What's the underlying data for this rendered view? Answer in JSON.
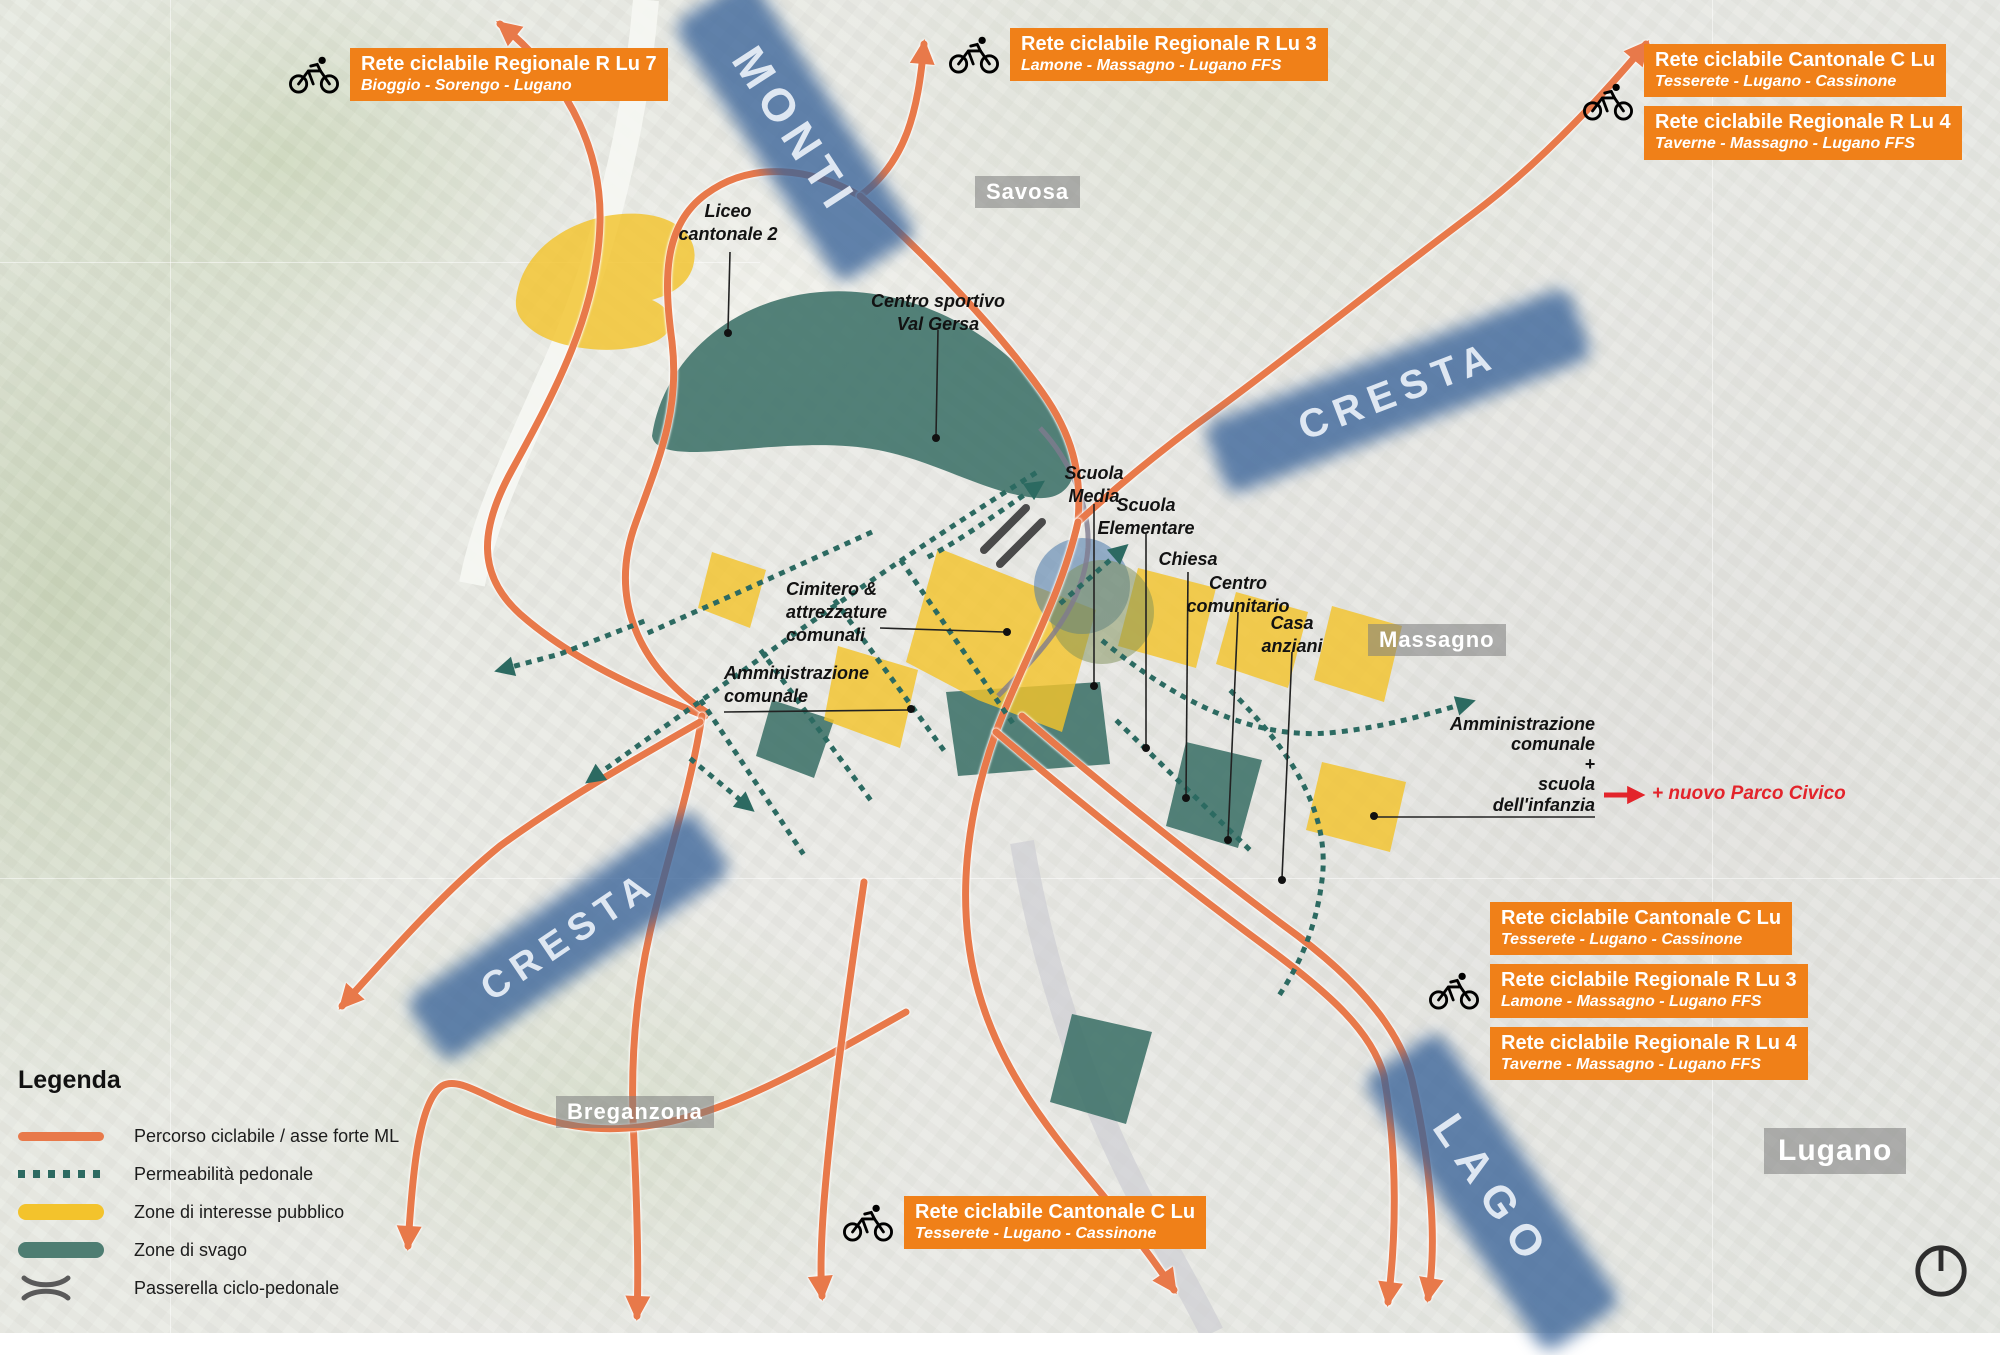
{
  "colors": {
    "route_orange": "#e8794a",
    "label_orange": "#f08018",
    "corridor_blue": "#3a669c",
    "zone_yellow": "#f3c32c",
    "zone_green": "#3c7168",
    "path_teal": "#2c6a61",
    "accent_red": "#e3242b",
    "passerella_gray": "#4a4a4a"
  },
  "corridors": [
    {
      "name": "MONTI"
    },
    {
      "name": "CRESTA"
    },
    {
      "name": "CRESTA"
    },
    {
      "name": "LAGO"
    }
  ],
  "places": [
    {
      "name": "Savosa"
    },
    {
      "name": "Massagno"
    },
    {
      "name": "Breganzona"
    },
    {
      "name": "Lugano"
    }
  ],
  "annotations": {
    "liceo": "Liceo\ncantonale 2",
    "centro_sportivo": "Centro sportivo\nVal Gersa",
    "scuola_media": "Scuola\nMedia",
    "scuola_elementare": "Scuola\nElementare",
    "chiesa": "Chiesa",
    "centro_comunitario": "Centro\ncomunitario",
    "casa_anziani": "Casa\nanziani",
    "cimitero": "Cimitero &\nattrezzature\ncomunali",
    "amministrazione_comunale": "Amministrazione\ncomunale",
    "amministrazione_scuola_infanzia": "Amministrazione\ncomunale\n+\nscuola\ndell'infanzia",
    "nuovo_parco_civico": "+ nuovo Parco Civico"
  },
  "route_labels": {
    "top_left": [
      {
        "title": "Rete ciclabile Regionale R Lu 7",
        "subtitle": "Bioggio - Sorengo - Lugano"
      }
    ],
    "top_center": [
      {
        "title": "Rete ciclabile Regionale R Lu 3",
        "subtitle": "Lamone - Massagno - Lugano FFS"
      }
    ],
    "top_right": [
      {
        "title": "Rete ciclabile Cantonale C Lu",
        "subtitle": "Tesserete - Lugano - Cassinone"
      },
      {
        "title": "Rete ciclabile Regionale R Lu 4",
        "subtitle": "Taverne - Massagno - Lugano FFS"
      }
    ],
    "mid_right": [
      {
        "title": "Rete ciclabile Cantonale C Lu",
        "subtitle": "Tesserete - Lugano - Cassinone"
      },
      {
        "title": "Rete ciclabile Regionale R Lu 3",
        "subtitle": "Lamone - Massagno - Lugano FFS"
      },
      {
        "title": "Rete ciclabile Regionale R Lu 4",
        "subtitle": "Taverne - Massagno - Lugano FFS"
      }
    ],
    "bottom_center": [
      {
        "title": "Rete ciclabile Cantonale C Lu",
        "subtitle": "Tesserete - Lugano - Cassinone"
      }
    ]
  },
  "legend": {
    "title": "Legenda",
    "items": [
      {
        "type": "bike-route-line",
        "label": "Percorso ciclabile / asse forte ML"
      },
      {
        "type": "pedestrian-dashed",
        "label": "Permeabilità pedonale"
      },
      {
        "type": "public-interest-zone",
        "label": "Zone di interesse pubblico"
      },
      {
        "type": "recreation-zone",
        "label": "Zone di svago"
      },
      {
        "type": "cycle-pedestrian-bridge",
        "label": "Passerella ciclo-pedonale"
      }
    ]
  },
  "icons": {
    "bicycle-icon": "black cyclist pictogram",
    "compass-icon": "circle with north line",
    "arrow-icon": "route direction arrowhead"
  }
}
